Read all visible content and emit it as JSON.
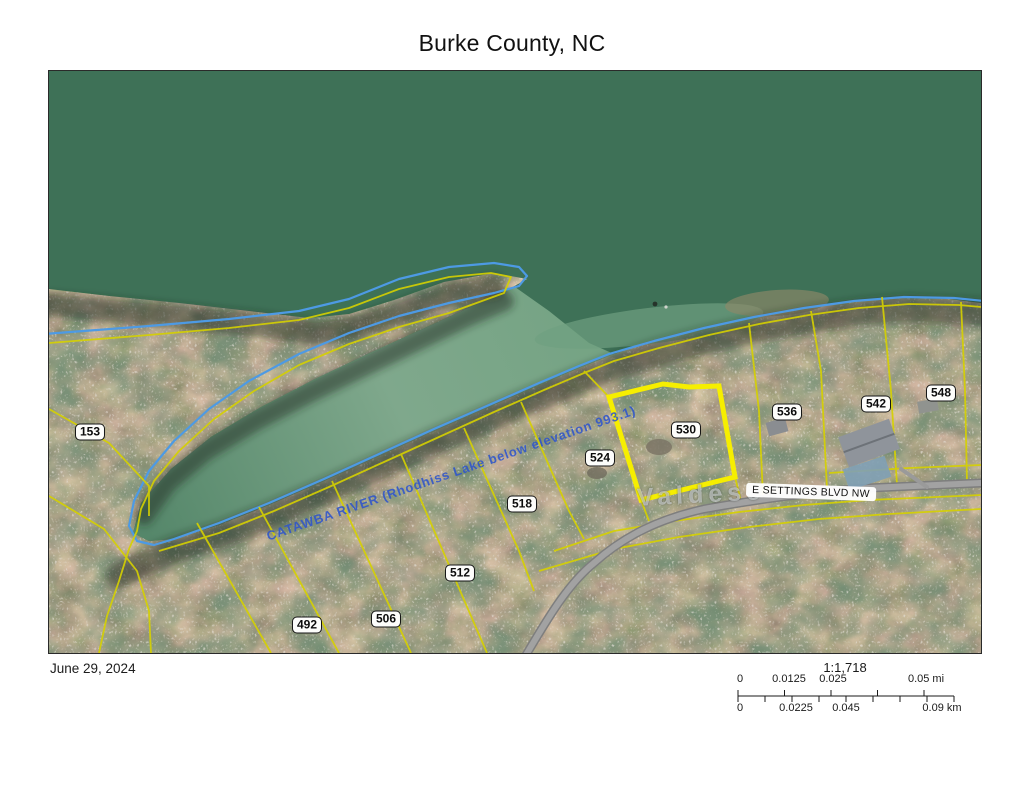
{
  "title": "Burke County, NC",
  "footer": {
    "date": "June 29, 2024"
  },
  "scale": {
    "ratio": "1:1,718",
    "mi_labels": [
      "0",
      "0.0125",
      "0.025",
      "0.05 mi"
    ],
    "km_labels": [
      "0",
      "0.0225",
      "0.045",
      "0.09 km"
    ]
  },
  "map": {
    "road_label": "E SETTINGS BLVD NW",
    "city_label": "Valdese",
    "river_label": "CATAWBA RIVER (Rhodhiss Lake below elevation 993.1)",
    "highlighted_parcel": "530",
    "parcels": [
      {
        "label": "153"
      },
      {
        "label": "492"
      },
      {
        "label": "506"
      },
      {
        "label": "512"
      },
      {
        "label": "518"
      },
      {
        "label": "524"
      },
      {
        "label": "530"
      },
      {
        "label": "536"
      },
      {
        "label": "542"
      },
      {
        "label": "548"
      }
    ],
    "colors": {
      "water": "#3e7157",
      "bay_light": "#7fa68a",
      "parcel_line": "#d6d100",
      "highlight": "#f6ee00",
      "shoreline": "#4d9ae4",
      "road": "#a2a2a2",
      "river_label": "#2f55cc"
    }
  }
}
